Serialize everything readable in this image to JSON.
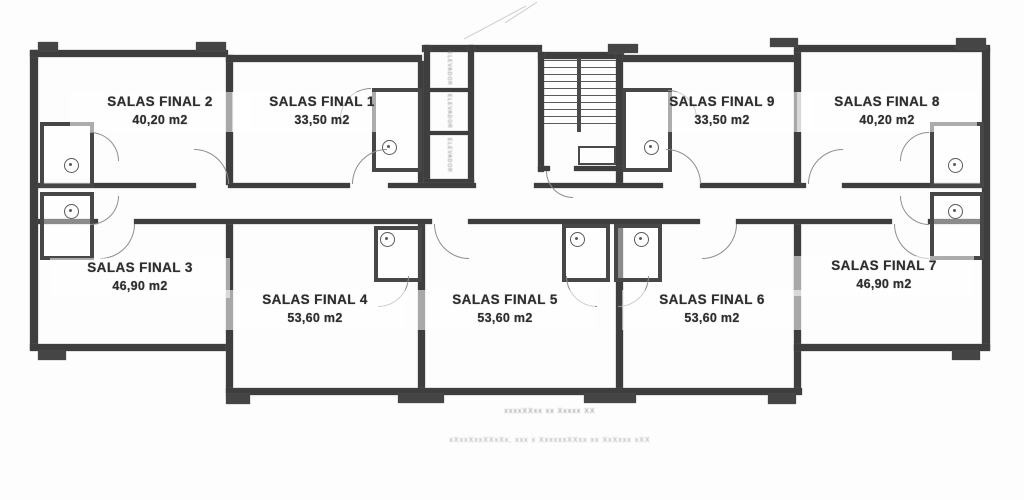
{
  "rooms": [
    {
      "name": "SALAS FINAL 1",
      "area": "33,50 m2"
    },
    {
      "name": "SALAS FINAL 2",
      "area": "40,20 m2"
    },
    {
      "name": "SALAS FINAL 3",
      "area": "46,90 m2"
    },
    {
      "name": "SALAS FINAL 4",
      "area": "53,60 m2"
    },
    {
      "name": "SALAS FINAL 5",
      "area": "53,60 m2"
    },
    {
      "name": "SALAS FINAL 6",
      "area": "53,60 m2"
    },
    {
      "name": "SALAS FINAL 7",
      "area": "46,90 m2"
    },
    {
      "name": "SALAS FINAL 8",
      "area": "40,20 m2"
    },
    {
      "name": "SALAS FINAL 9",
      "area": "33,50 m2"
    }
  ],
  "core": {
    "elevator_label": "ELEVADOR"
  },
  "captions": {
    "line1": "xxxxXXxx xx Xxxxx XX",
    "line2": "xXxxXxxXXxXx, xxx x XxxxxxXXxx xx XxXxxx xXX"
  },
  "colors": {
    "wall": "#3e3e3e",
    "paper": "#fdfdfd",
    "thin_line": "#8f8f8f",
    "label_text": "#2e2e2e"
  }
}
